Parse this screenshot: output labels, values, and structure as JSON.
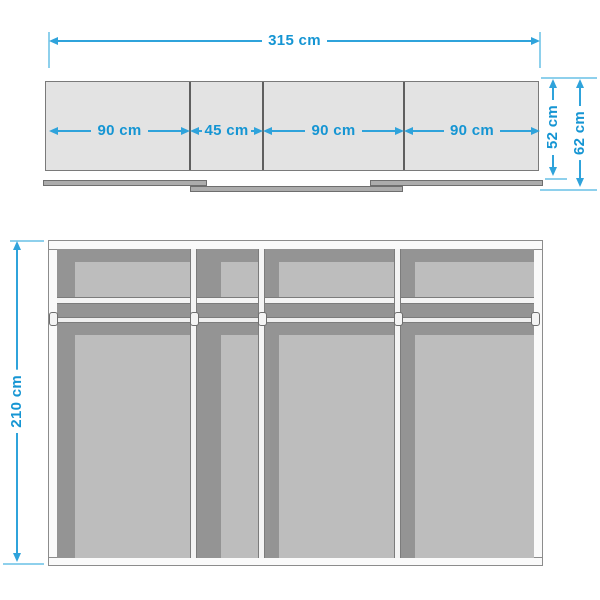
{
  "diagram": "wardrobe-dimension-drawing",
  "colors": {
    "dimension_text": "#1595d3",
    "dimension_line": "#2fa3db",
    "extension_line": "#8ed0ec",
    "panel_light_gray": "#e3e3e3",
    "interior_dark_gray": "#949494",
    "interior_light_gray": "#bdbdbd",
    "frame_white": "#fafafa",
    "outline_gray": "#7c7c7c"
  },
  "top_view": {
    "total_width": "315 cm",
    "sections": [
      "90 cm",
      "45 cm",
      "90 cm",
      "90 cm"
    ],
    "depth_body": "52 cm",
    "depth_total": "62 cm"
  },
  "front_view": {
    "height": "210 cm"
  }
}
